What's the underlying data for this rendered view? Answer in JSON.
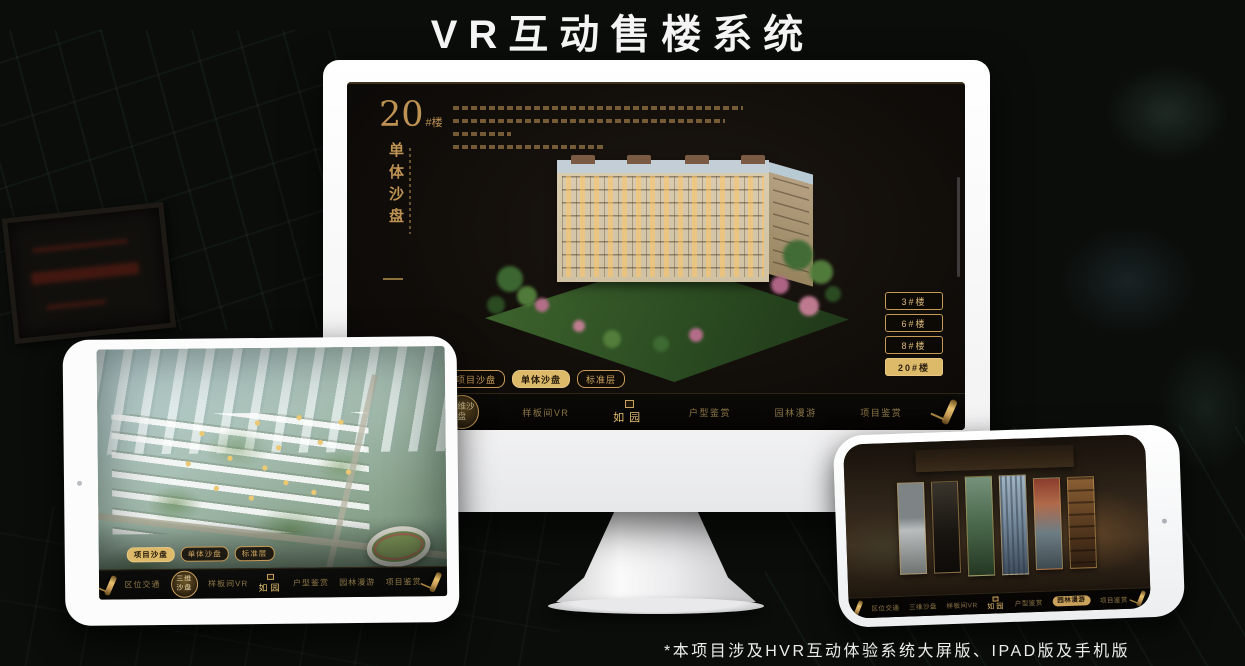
{
  "page": {
    "title": "VR互动售楼系统",
    "footnote": "*本项目涉及HVR互动体验系统大屏版、IPAD版及手机版"
  },
  "colors": {
    "gold": "#c79a55",
    "gold_fill": "#ddb96a",
    "title_white": "#f4f4f4",
    "screen_bg": "#130f0a"
  },
  "monitor": {
    "heading": {
      "number": "20",
      "suffix": "#楼",
      "vertical_title": "单体沙盘"
    },
    "floor_buttons": [
      {
        "label": "3#楼",
        "active": false
      },
      {
        "label": "6#楼",
        "active": false
      },
      {
        "label": "8#楼",
        "active": false
      },
      {
        "label": "20#楼",
        "active": true
      }
    ],
    "tabs": [
      {
        "label": "项目沙盘",
        "active": false
      },
      {
        "label": "单体沙盘",
        "active": true
      },
      {
        "label": "标准层",
        "active": false
      }
    ],
    "nav": {
      "logo": "如园",
      "items": [
        {
          "label": "区位交通",
          "active": false
        },
        {
          "label": "三维沙盘",
          "active": true
        },
        {
          "label": "样板间VR",
          "active": false
        },
        {
          "label": "户型鉴赏",
          "active": false
        },
        {
          "label": "园林漫游",
          "active": false
        },
        {
          "label": "项目鉴赏",
          "active": false
        }
      ]
    }
  },
  "tablet": {
    "tabs": [
      {
        "label": "项目沙盘",
        "active": true
      },
      {
        "label": "单体沙盘",
        "active": false
      },
      {
        "label": "标准层",
        "active": false
      }
    ],
    "nav": {
      "logo": "如园",
      "items": [
        {
          "label": "区位交通",
          "active": false
        },
        {
          "label": "三维沙盘",
          "active": true
        },
        {
          "label": "样板间VR",
          "active": false
        },
        {
          "label": "户型鉴赏",
          "active": false
        },
        {
          "label": "园林漫游",
          "active": false
        },
        {
          "label": "项目鉴赏",
          "active": false
        }
      ]
    }
  },
  "phone": {
    "nav": {
      "logo": "如园",
      "items": [
        {
          "label": "区位交通",
          "active": false
        },
        {
          "label": "三维沙盘",
          "active": false
        },
        {
          "label": "样板间VR",
          "active": false
        },
        {
          "label": "户型鉴赏",
          "active": false
        },
        {
          "label": "园林漫游",
          "active": true
        },
        {
          "label": "项目鉴赏",
          "active": false
        }
      ]
    }
  }
}
